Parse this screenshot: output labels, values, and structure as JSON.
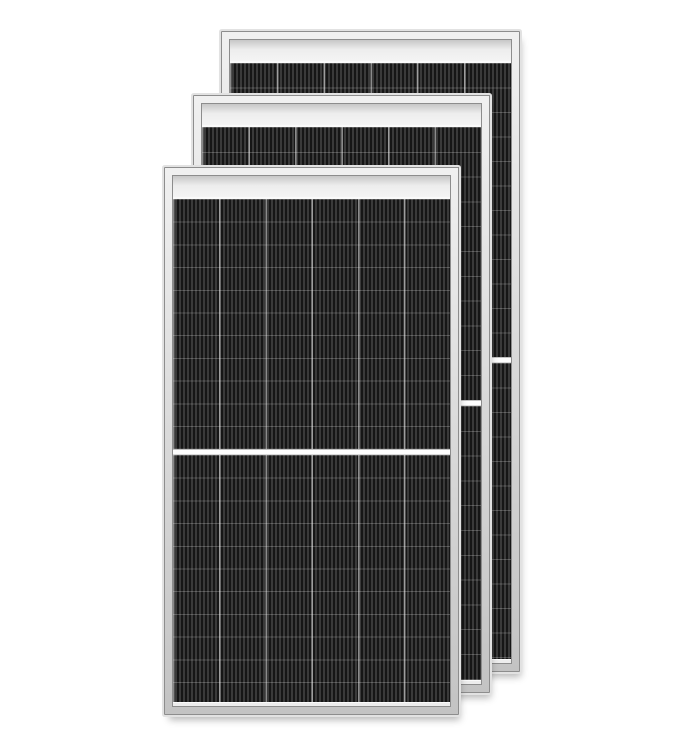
{
  "image": {
    "width": 684,
    "height": 748,
    "subject": "Three overlapping all-black monocrystalline half-cut solar photovoltaic panels on a white background",
    "panel_count": 3,
    "cell_columns_per_panel": 6,
    "halves_per_panel": 2
  },
  "scene": {
    "colors": {
      "background": "#ffffff",
      "frame_rim": "#e2e2e2",
      "frame_outline": "#8d8d8d",
      "frame_highlight": "#f0f0f0",
      "frame_fill": "#d7d7d7",
      "frame_shade": "#c3c3c3",
      "glass_margin": "#ededed",
      "cell_dark": "#161616",
      "cell_stripe": "#3a3a3a",
      "column_divider": "rgba(255,255,255,0.50)",
      "row_line": "rgba(255,255,255,0.22)",
      "half_divider": "#fdfdfd",
      "drop_shadow": "rgba(0,0,0,0.28)"
    },
    "panels": [
      {
        "name": "back-solar-panel",
        "outer": {
          "left": 219,
          "top": 29,
          "width": 303,
          "height": 645
        },
        "column_width": 46.8,
        "row_height": 24.5,
        "upper_half_height": 294,
        "z": 1
      },
      {
        "name": "middle-solar-panel",
        "outer": {
          "left": 191,
          "top": 93,
          "width": 301,
          "height": 602
        },
        "column_width": 46.5,
        "row_height": 24.8,
        "upper_half_height": 273,
        "z": 2
      },
      {
        "name": "front-solar-panel",
        "outer": {
          "left": 162,
          "top": 165,
          "width": 299,
          "height": 552
        },
        "column_width": 46.2,
        "row_height": 22.7,
        "upper_half_height": 250,
        "z": 3
      }
    ]
  }
}
